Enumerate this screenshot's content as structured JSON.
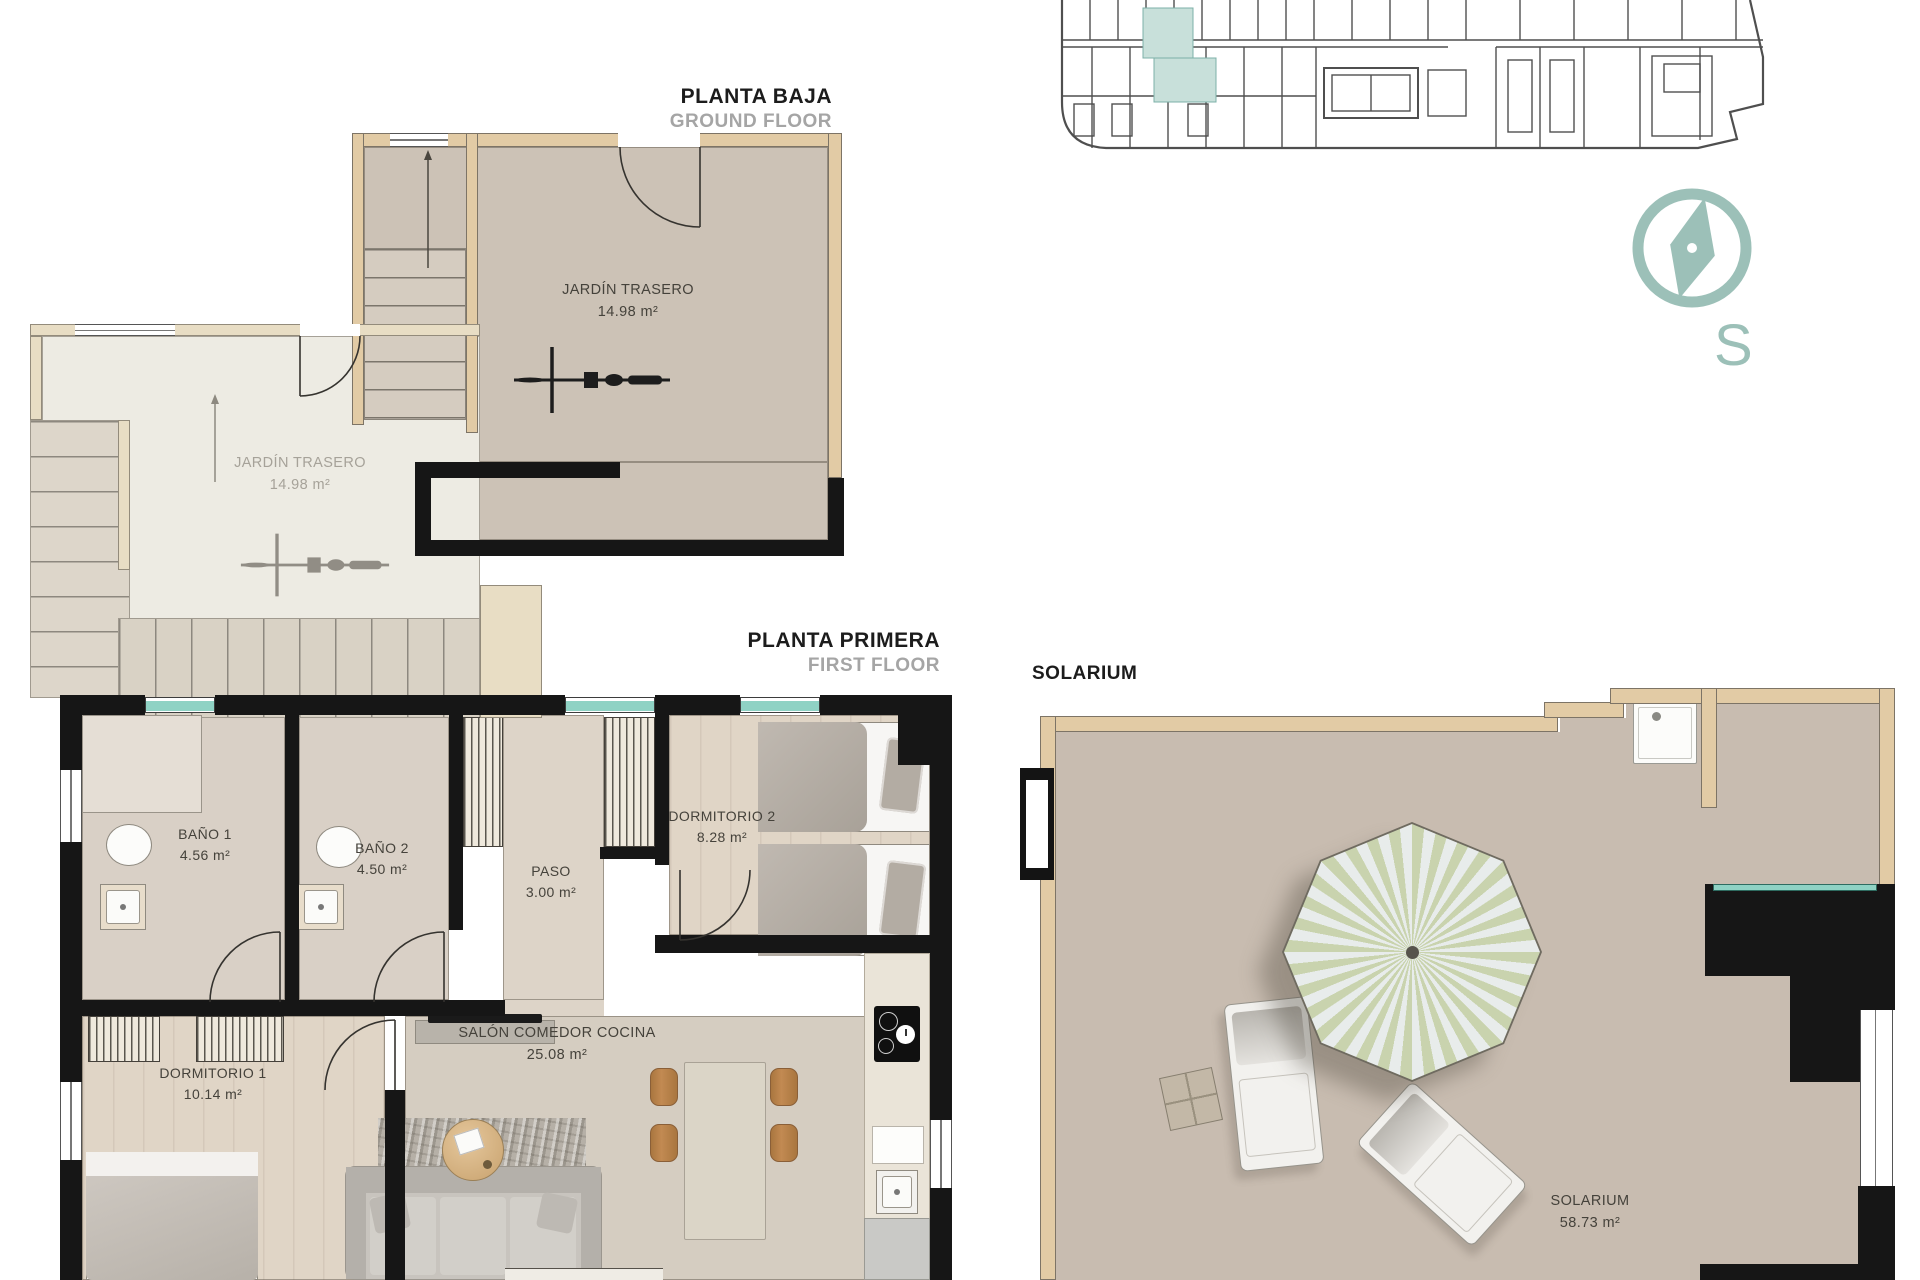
{
  "sheet": {
    "background": "#ffffff"
  },
  "sections": {
    "ground_floor": {
      "title": "PLANTA BAJA",
      "subtitle": "GROUND FLOOR"
    },
    "first_floor": {
      "title": "PLANTA PRIMERA",
      "subtitle": "FIRST FLOOR"
    },
    "solarium": {
      "title": "SOLARIUM"
    }
  },
  "compass": {
    "letter": "S"
  },
  "rooms": {
    "jardin_trasero_unit_a": {
      "name": "JARDÍN TRASERO",
      "area": "14.98 m²"
    },
    "jardin_trasero_unit_b": {
      "name": "JARDÍN TRASERO",
      "area": "14.98 m²"
    },
    "bano_1": {
      "name": "BAÑO 1",
      "area": "4.56 m²"
    },
    "bano_2": {
      "name": "BAÑO 2",
      "area": "4.50 m²"
    },
    "paso": {
      "name": "PASO",
      "area": "3.00 m²"
    },
    "dormitorio_2": {
      "name": "DORMITORIO 2",
      "area": "8.28 m²"
    },
    "dormitorio_1": {
      "name": "DORMITORIO 1",
      "area": "10.14 m²"
    },
    "salon_comedor_cocina": {
      "name": "SALÓN COMEDOR COCINA",
      "area": "25.08 m²"
    },
    "solarium": {
      "name": "SOLARIUM",
      "area": "58.73 m²"
    }
  },
  "colors": {
    "compass_teal": "#9cc0b8",
    "window_teal": "#8fd2c4",
    "site_highlight_teal": "#c8e0da",
    "wall_tan": "#e2cba5",
    "wall_black": "#161616",
    "floor_dark_unit": "#ccc2b6",
    "floor_light_unit": "#edebe3",
    "floor_solarium": "#c8bcb0",
    "parasol_green": "#c9d3ae",
    "title_black": "#1c1c1c",
    "subtitle_gray": "#a5a5a5"
  }
}
